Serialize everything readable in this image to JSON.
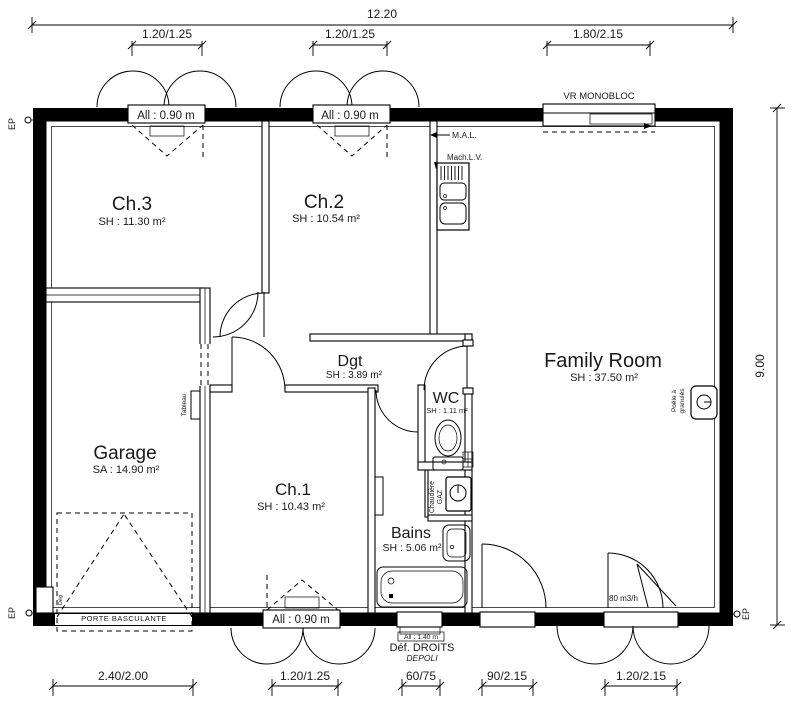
{
  "dimensions": {
    "top_total": "12.20",
    "top_windows": [
      "1.20/1.25",
      "1.20/1.25",
      "1.80/2.15"
    ],
    "right_height": "9.00",
    "bottom": [
      "2.40/2.00",
      "1.20/1.25",
      "60/75",
      "90/2.15",
      "1.20/2.15"
    ]
  },
  "rooms": [
    {
      "name": "Ch.3",
      "area": "SH : 11.30 m²"
    },
    {
      "name": "Ch.2",
      "area": "SH : 10.54 m²"
    },
    {
      "name": "Family Room",
      "area": "SH : 37.50 m²"
    },
    {
      "name": "Garage",
      "area": "SA : 14.90 m²"
    },
    {
      "name": "Ch.1",
      "area": "SH : 10.43 m²"
    },
    {
      "name": "Dgt",
      "area": "SH : 3.89 m²"
    },
    {
      "name": "WC",
      "area": "SH : 1.11 m²"
    },
    {
      "name": "Bains",
      "area": "SH : 5.06 m²"
    }
  ],
  "windows": {
    "all090": "All : 0.90 m",
    "vr_label": "VR MONOBLOC",
    "bains_height_label": "All : 1.40 m",
    "bains_glass_1": "Déf. DROITS",
    "bains_glass_2": "DEPOLI"
  },
  "equipment": {
    "mal": "M.A.L.",
    "machlv": "Mach.L.V.",
    "tableau": "Tableau",
    "chaudiere_1": "Chaudière",
    "chaudiere_2": "GAZ",
    "poele_1": "Poêle à",
    "poele_2": "granulés",
    "garage_door": "PORTE BASCULANTE",
    "airflow": "80 m3/h",
    "deg": "Dég"
  },
  "markers": {
    "ep": "EP"
  }
}
